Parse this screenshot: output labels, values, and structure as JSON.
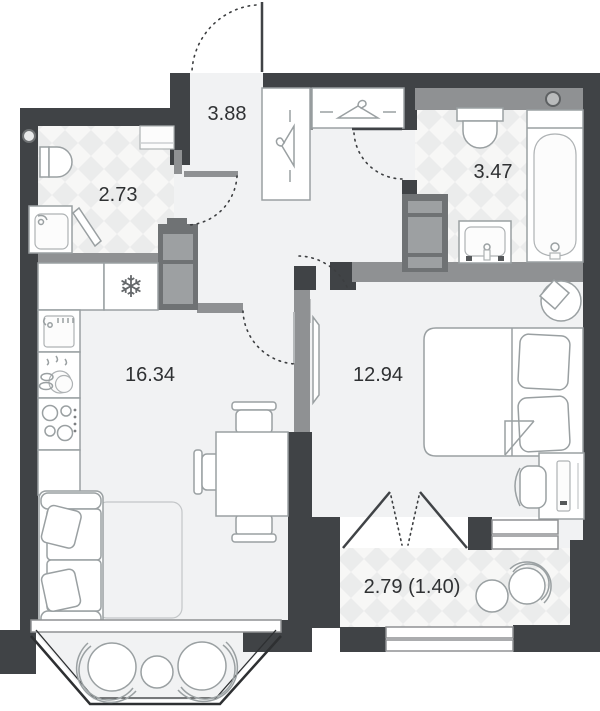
{
  "plan": {
    "type": "apartment-floor-plan",
    "rooms": {
      "wc": {
        "area": "2.73"
      },
      "hallway": {
        "area": "3.88"
      },
      "bathroom": {
        "area": "3.47"
      },
      "kitchen_living": {
        "area": "16.34"
      },
      "bedroom": {
        "area": "12.94"
      },
      "balcony": {
        "area": "2.79 (1.40)"
      }
    },
    "icons": {
      "fridge_snowflake": "❄"
    },
    "colors": {
      "wall_dark": "#404346",
      "wall_gray": "#8f9193",
      "floor": "#f1f2f3",
      "tile_light": "#f7f7f6",
      "tile_dark": "#ebecec",
      "furniture_stroke": "#9aa0a2",
      "label_text": "#2f3133"
    }
  }
}
